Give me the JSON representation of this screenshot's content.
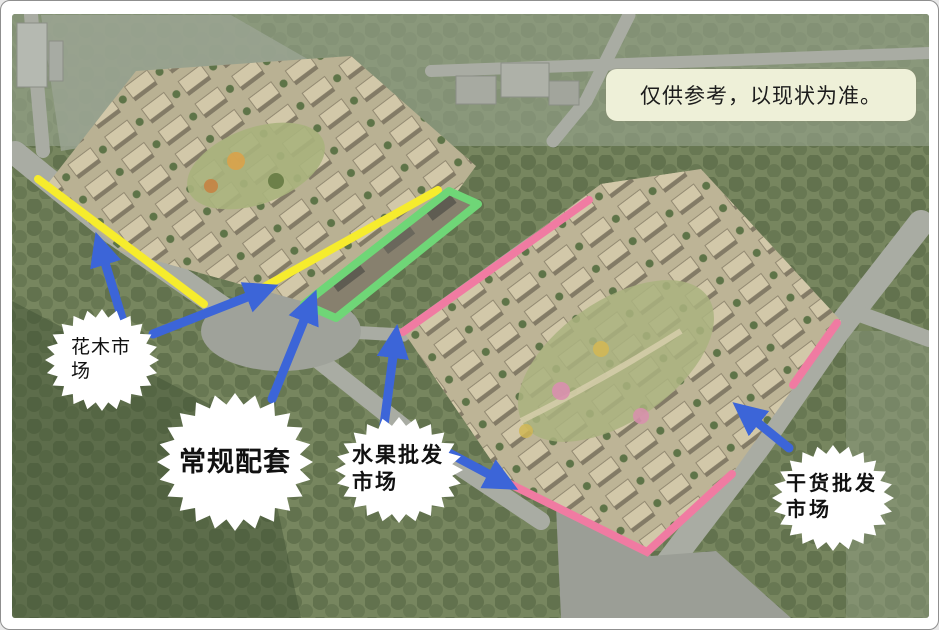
{
  "notice": {
    "text": "仅供参考，以现状为准。"
  },
  "callouts": {
    "flower_market": {
      "label": "花木市场"
    },
    "general_facilities": {
      "label": "常规配套"
    },
    "fruit_market": {
      "label": "水果批发市场"
    },
    "dry_goods_market": {
      "label": "干货批发市场"
    }
  },
  "colors": {
    "route_yellow": "#f6ec2d",
    "strip_green": "#6fd677",
    "boundary_pink": "#f07ba2",
    "arrow_blue": "#3c65d8",
    "bubble_bg": "#ffffff",
    "notice_bg": "#eef0d8"
  }
}
